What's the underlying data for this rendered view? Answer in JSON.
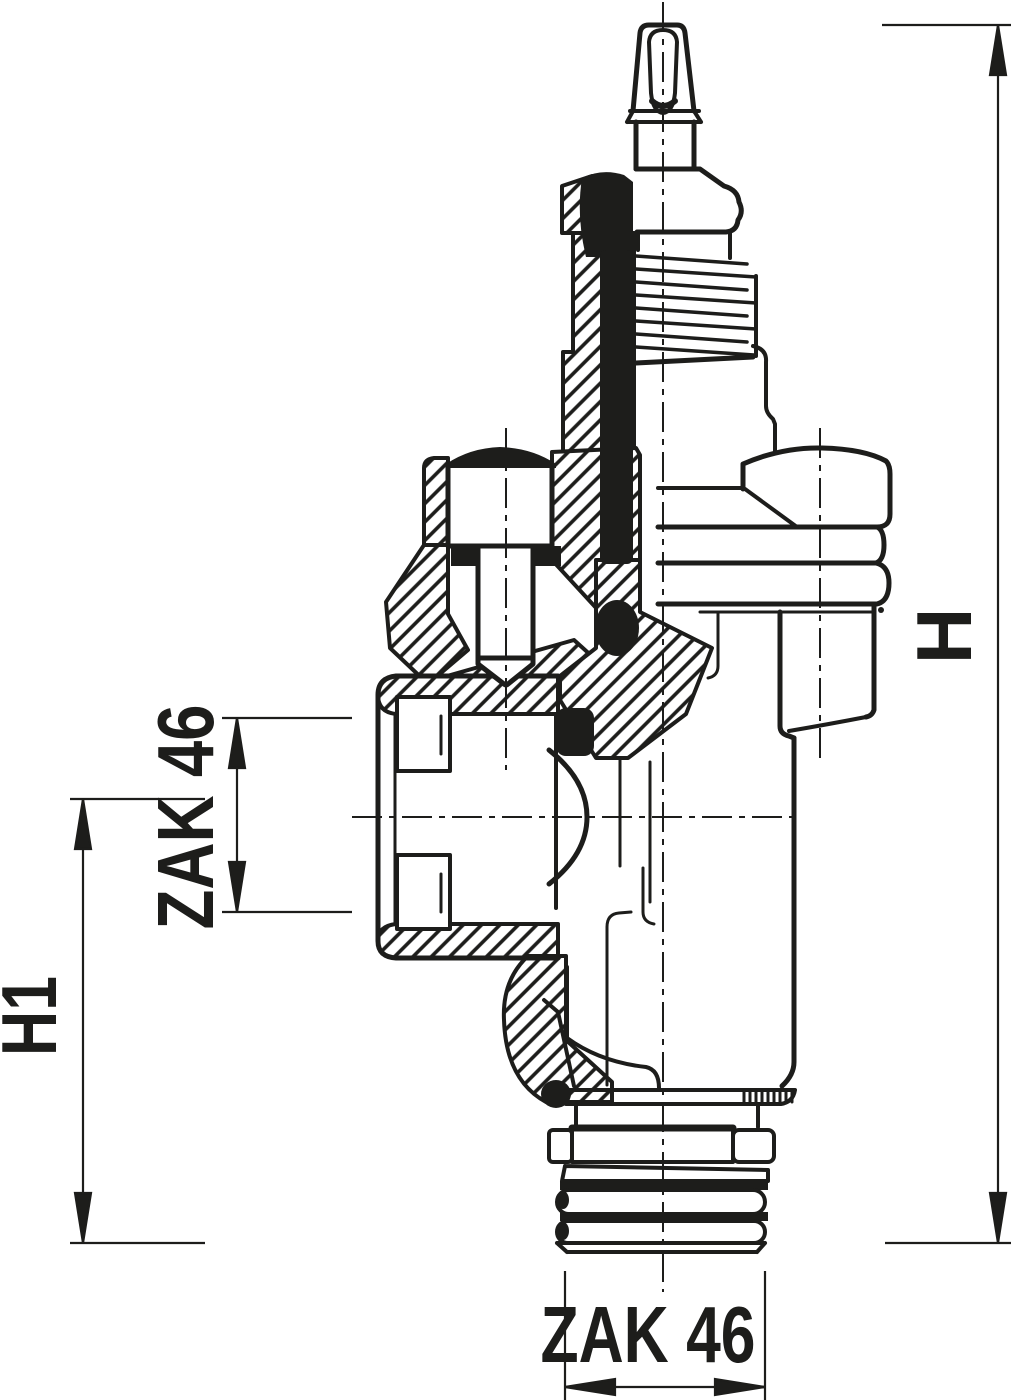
{
  "drawing": {
    "type": "technical-cross-section",
    "subject": "valve insert sectional drawing",
    "colors": {
      "ink": "#1d1d1b",
      "background": "#ffffff"
    },
    "dimensions": {
      "h": {
        "label": "H"
      },
      "h1": {
        "label": "H1"
      },
      "zak_left": {
        "label": "ZAK 46"
      },
      "zak_bottom": {
        "label": "ZAK 46"
      }
    }
  }
}
